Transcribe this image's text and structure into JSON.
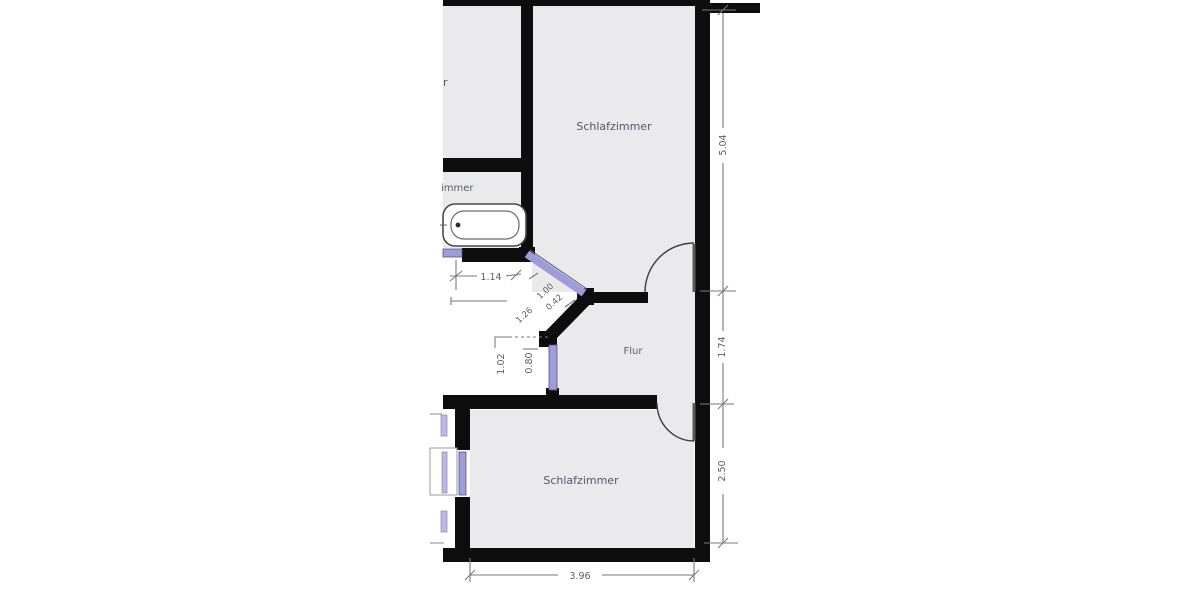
{
  "plan": {
    "type": "floor-plan",
    "rooms": {
      "bedroom_top": {
        "label": "Schlafzimmer"
      },
      "bedroom_bottom": {
        "label": "Schlafzimmer"
      },
      "hallway": {
        "label": "Flur"
      },
      "left_room_fragment": {
        "label": "r"
      },
      "bath_room_fragment": {
        "label": "immer"
      }
    },
    "fixtures": {
      "bathtub": "bathtub"
    },
    "dimensions": {
      "right_top": "5.04",
      "right_mid": "1.74",
      "right_bottom": "2.50",
      "bottom": "3.96",
      "bath_width": "1.14",
      "diag_window": "1.00",
      "diag_segment": "0.42",
      "diag_wall": "1.26",
      "niche_left": "1.02",
      "niche_right": "0.80"
    },
    "colors": {
      "wall": "#0d0d0d",
      "room_fill": "#eaeaec",
      "window": "#9d9dd9",
      "dimension_line": "#7a7a7a",
      "label_text": "#4a5a68"
    }
  }
}
